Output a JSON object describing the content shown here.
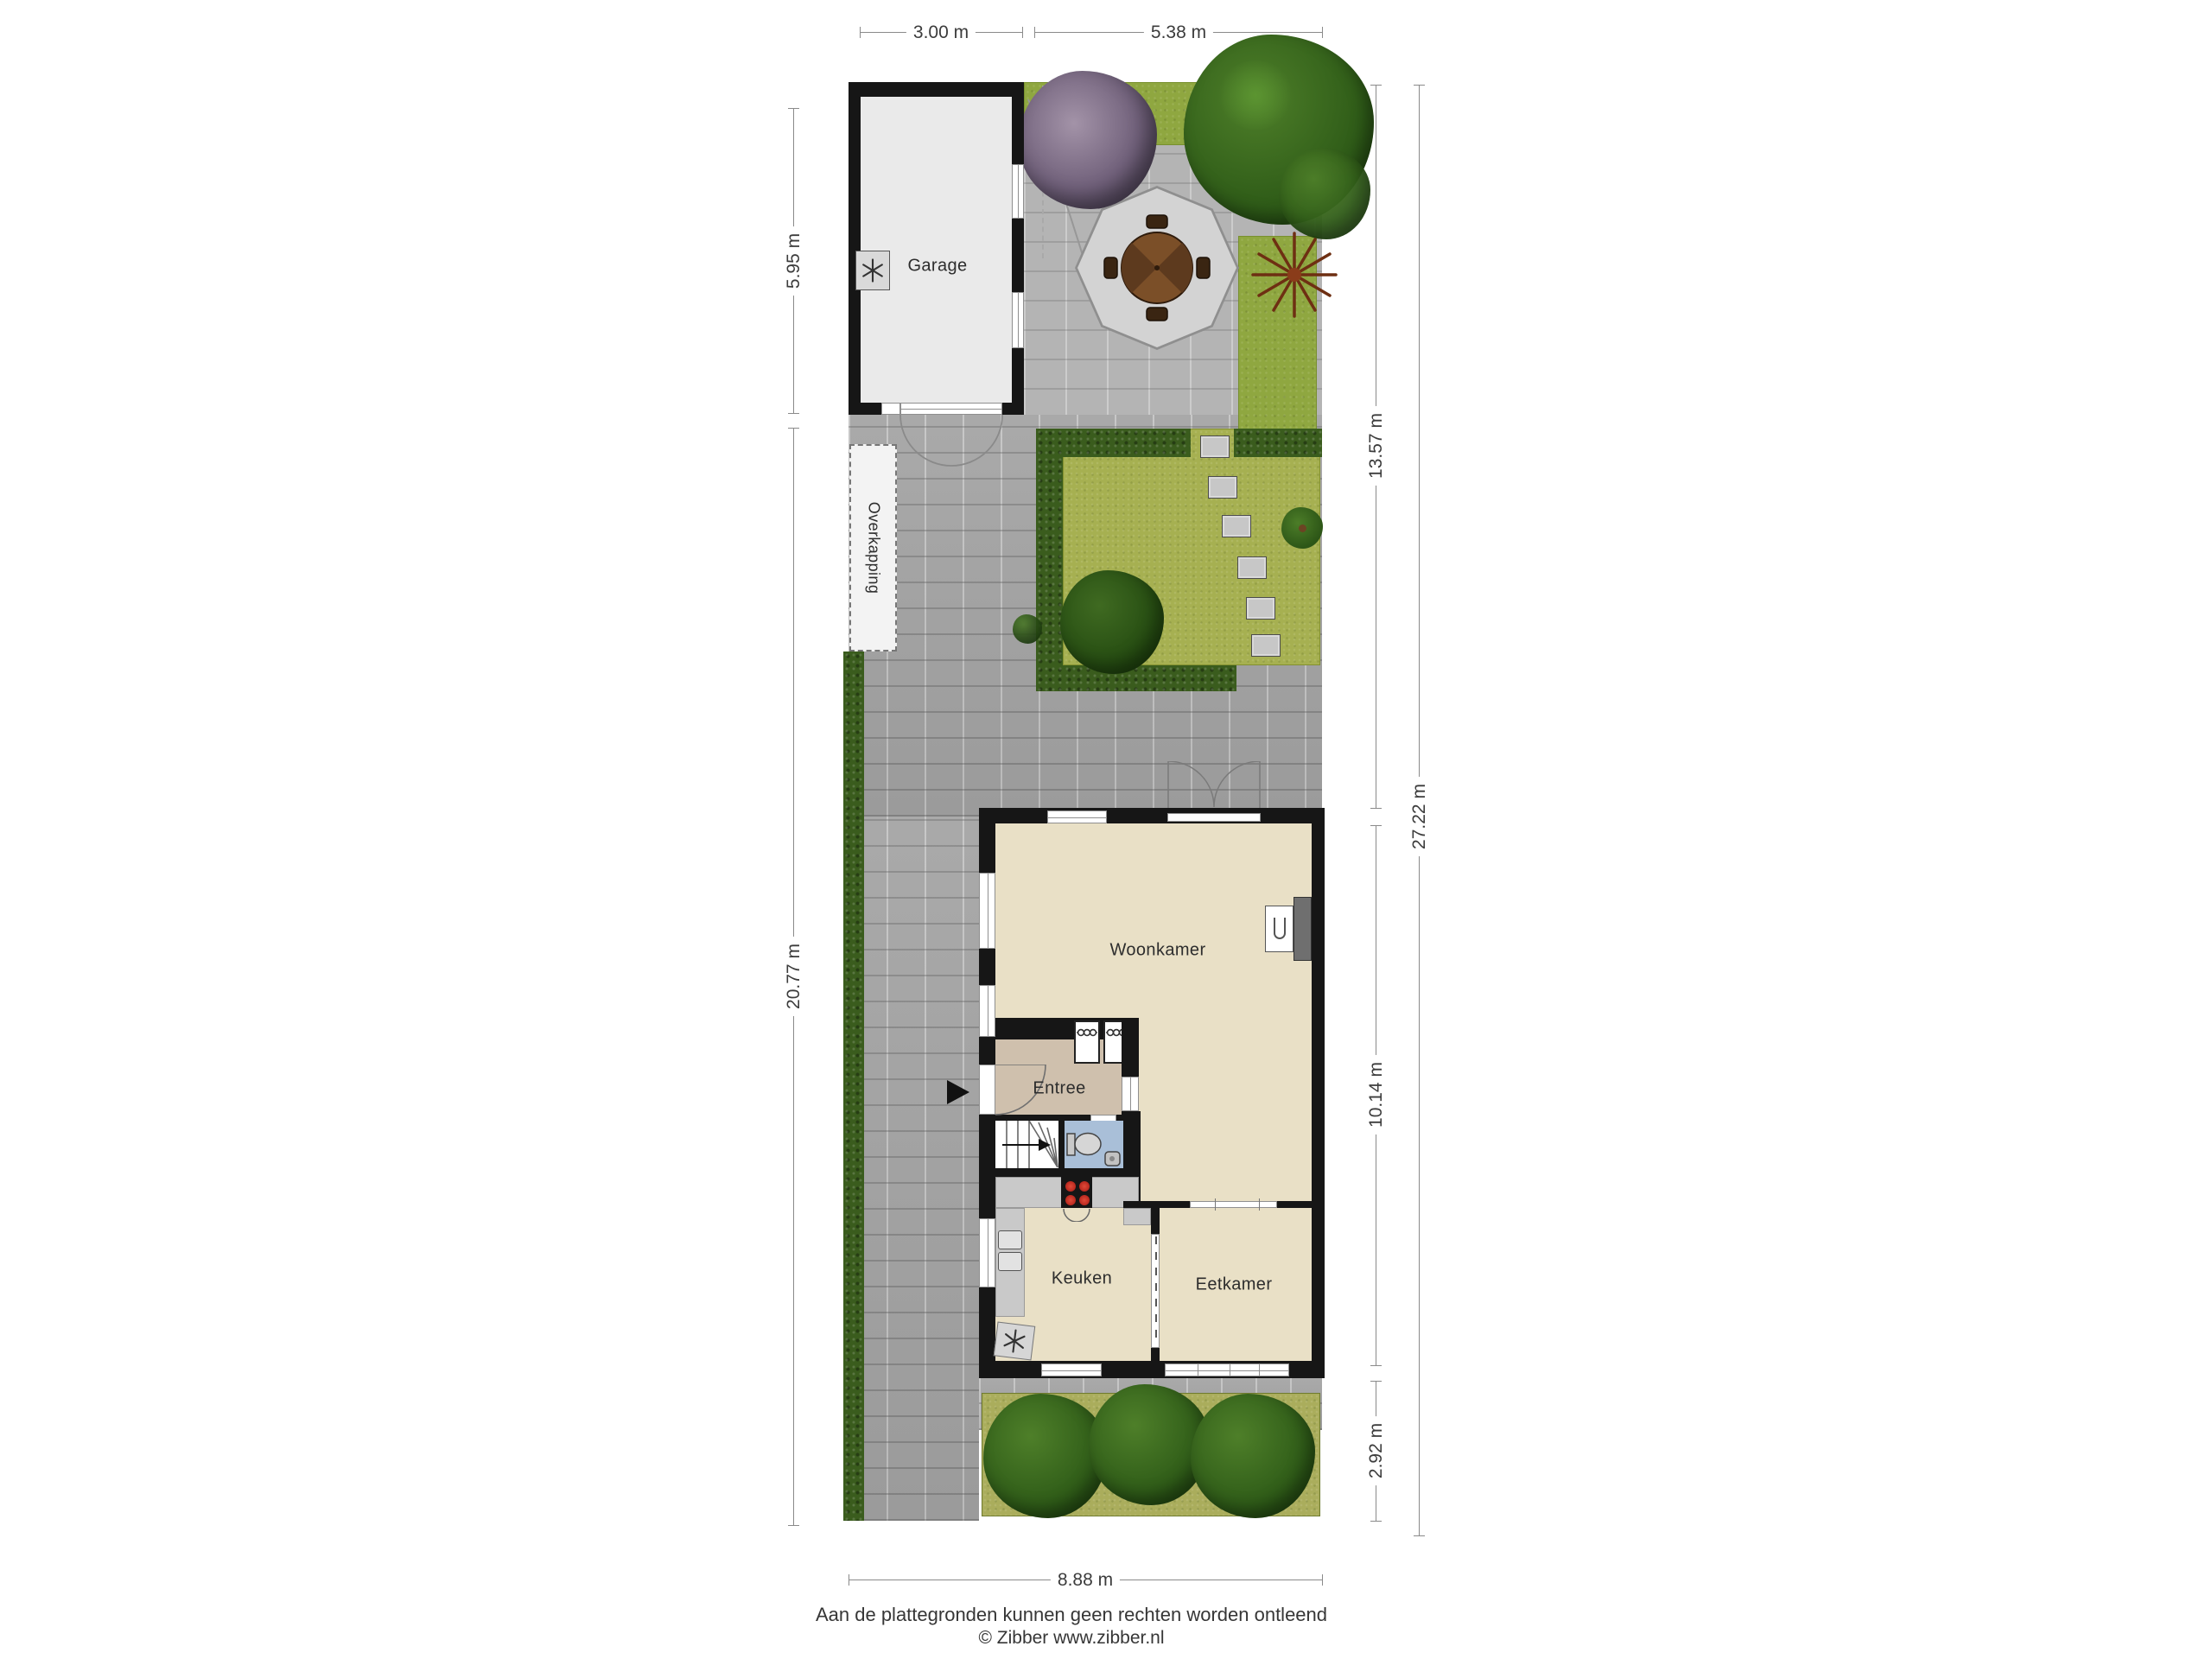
{
  "floorplan": {
    "room_labels": {
      "garage": "Garage",
      "overkapping": "Overkapping",
      "woonkamer": "Woonkamer",
      "entree": "Entree",
      "keuken": "Keuken",
      "eetkamer": "Eetkamer"
    },
    "dimensions": {
      "top_garage_width": "3.00 m",
      "top_garden_width": "5.38 m",
      "left_garage_depth": "5.95 m",
      "left_remaining_depth": "20.77 m",
      "right_back_garden_depth": "13.57 m",
      "right_house_depth": "10.14 m",
      "right_front_garden_depth": "2.92 m",
      "right_total_depth": "27.22 m",
      "bottom_plot_width": "8.88 m"
    },
    "footer": {
      "disclaimer": "Aan de plattegronden kunnen geen rechten worden ontleend",
      "copyright": "© Zibber www.zibber.nl"
    },
    "colors": {
      "wall": "#161616",
      "room_floor": "#e9e0c6",
      "entree_floor": "#cfc0ad",
      "toilet_floor": "#a9bfd8",
      "paving": "#a3a3a3",
      "patio": "#b4b4b4",
      "grass": "#8fa740",
      "lawn": "#a6b051",
      "hedge": "#3a5c1d",
      "counter": "#c9c9c9",
      "hob": "#161616",
      "burner": "#c9241f",
      "table_wood": "#6f4422",
      "tree_green": "#2f6b1d",
      "tree_purple": "#70607a",
      "fern_brown": "#7c3a1d"
    }
  }
}
